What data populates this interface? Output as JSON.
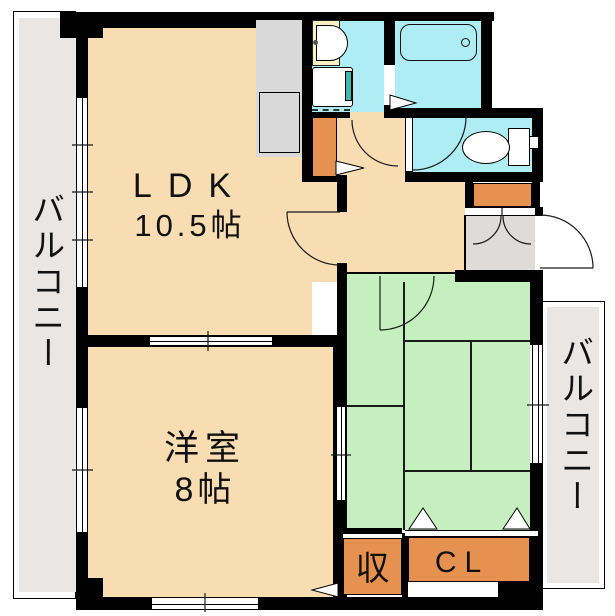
{
  "floorplan": {
    "rooms": {
      "ldk": {
        "line1": "LDK",
        "line2": "10.5帖"
      },
      "western": {
        "line1": "洋室",
        "line2": "8帖"
      },
      "balcony_left": {
        "label": "バルコニー"
      },
      "balcony_right": {
        "label": "バルコニー"
      },
      "storage": {
        "label": "収"
      },
      "closet": {
        "label": "CL"
      }
    },
    "fixtures": [
      "kitchen-counter",
      "sink-unit",
      "washbasin-vanity",
      "washing-machine-pan",
      "bathtub",
      "toilet",
      "shoe-cabinet",
      "hall-storage"
    ],
    "colors": {
      "wall": "#000000",
      "floor": "#F8DCB2",
      "tatami": "#C6EFC0",
      "wet": "#AEEDF3",
      "vanity": "#F6F2C4",
      "washer_accent": "#3FB9AF",
      "storage": "#E6914F",
      "balcony": "#E9E6E4",
      "counter": "#D9D9D9",
      "genkan": "#DEDBD9"
    }
  }
}
